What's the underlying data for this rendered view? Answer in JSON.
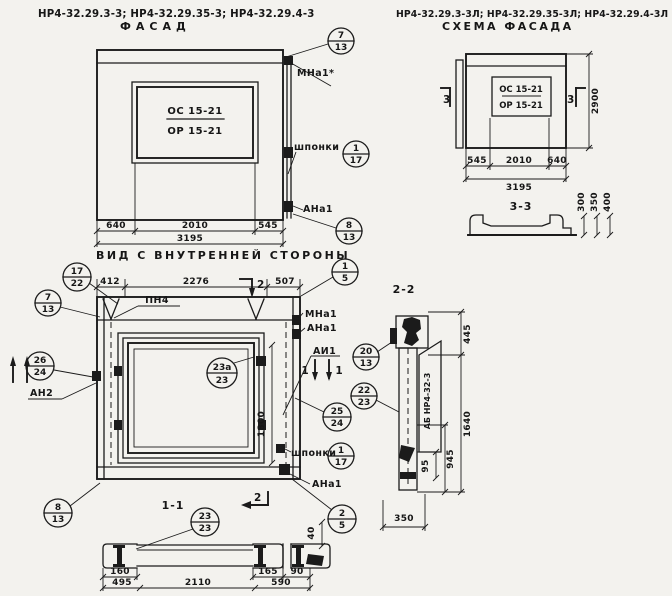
{
  "header": {
    "left_models": "НР4-32.29.3-3; НР4-32.29.35-3; НР4-32.29.4-3",
    "left_title": "ФАСАД",
    "right_models": "НР4-32.29.3-3Л; НР4-32.29.35-3Л; НР4-32.29.4-3Л",
    "right_title": "СХЕМА ФАСАДА"
  },
  "facade": {
    "mark_line1": "ОС 15-21",
    "mark_line2": "ОР 15-21",
    "dim_640": "640",
    "dim_2010": "2010",
    "dim_545": "545",
    "dim_3195": "3195",
    "label_mna1": "МНа1*",
    "label_shponki": "шпонки",
    "label_ana1": "АНа1",
    "balloon_7_13": {
      "num": "7",
      "den": "13"
    },
    "balloon_1_17": {
      "num": "1",
      "den": "17"
    },
    "balloon_8_13": {
      "num": "8",
      "den": "13"
    }
  },
  "inner_view": {
    "title": "ВИД С ВНУТРЕННЕЙ СТОРОНЫ",
    "dim_412": "412",
    "dim_2276": "2276",
    "dim_507": "507",
    "dim_1800": "1800",
    "label_pn4": "ПН4",
    "cut2_top": "2",
    "cut2_bottom": "2",
    "cut1_right_a": "1",
    "cut1_right_b": "1",
    "label_an2": "АН2",
    "label_mna1": "МНа1",
    "label_ana1_top": "АНа1",
    "label_ai1": "АИ1",
    "label_shponki": "шпонки",
    "label_ana1_bottom": "АНа1",
    "balloon_17_22": {
      "num": "17",
      "den": "22"
    },
    "balloon_7_13": {
      "num": "7",
      "den": "13"
    },
    "balloon_26_24": {
      "num": "26",
      "den": "24"
    },
    "balloon_1_5": {
      "num": "1",
      "den": "5"
    },
    "balloon_23a_23": {
      "num": "23а",
      "den": "23"
    },
    "balloon_25_24": {
      "num": "25",
      "den": "24"
    },
    "balloon_1_17": {
      "num": "1",
      "den": "17"
    },
    "balloon_2_5": {
      "num": "2",
      "den": "5"
    },
    "balloon_8_13": {
      "num": "8",
      "den": "13"
    }
  },
  "section11": {
    "title": "1-1",
    "balloon_23_23": {
      "num": "23",
      "den": "23"
    },
    "dim_40": "40",
    "dim_160": "160",
    "dim_495": "495",
    "dim_2110": "2110",
    "dim_165": "165",
    "dim_590": "590",
    "dim_90": "90"
  },
  "scheme": {
    "mark_line1": "ОС 15-21",
    "mark_line2": "ОР 15-21",
    "cut3_left": "3",
    "cut3_right": "3",
    "dim_2900": "2900",
    "dim_545": "545",
    "dim_2010": "2010",
    "dim_640": "640",
    "dim_3195": "3195",
    "section_title": "3-3",
    "dim_300": "300",
    "dim_350": "350",
    "dim_400": "400"
  },
  "section22": {
    "title": "2-2",
    "tag": "АБ НР4-32-3",
    "balloon_20_13": {
      "num": "20",
      "den": "13"
    },
    "balloon_22_23": {
      "num": "22",
      "den": "23"
    },
    "dim_445": "445",
    "dim_1640": "1640",
    "dim_95": "95",
    "dim_945": "945",
    "dim_350": "350"
  }
}
